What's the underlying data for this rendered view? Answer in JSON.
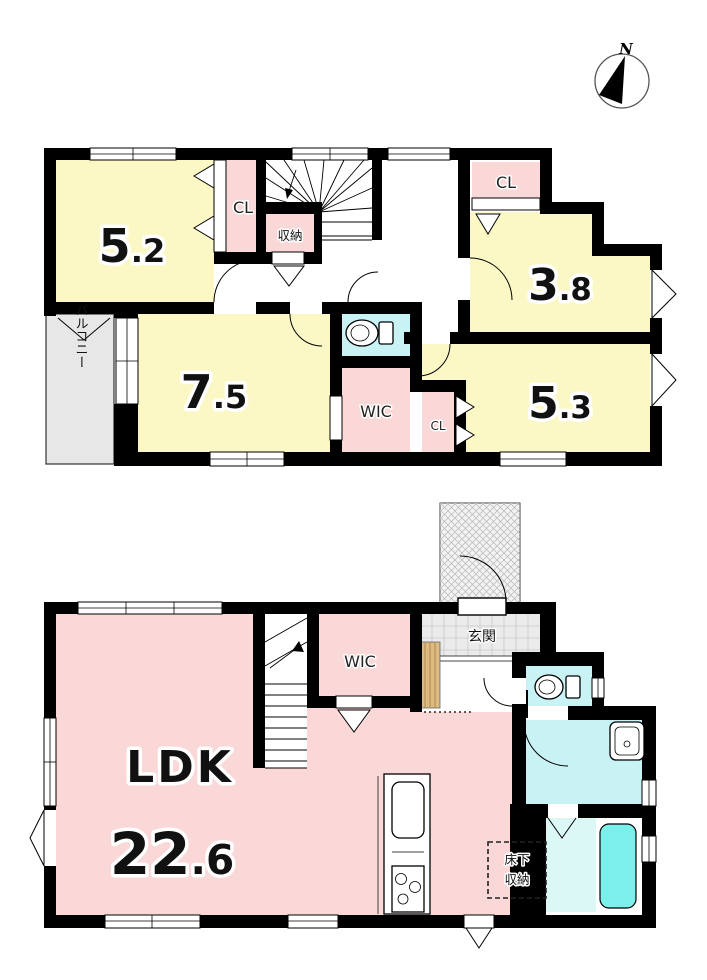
{
  "compass": {
    "north": "N"
  },
  "colors": {
    "room_yellow": "#FBF8C5",
    "room_pink": "#F9D8D7",
    "water_cyan": "#C9F2F5",
    "bathtub_cyan": "#7BEFEA",
    "shower_cyan": "#DCF8F6",
    "balcony_gray": "#E7E7E7",
    "entrance_tile_gray": "#EBEBEB",
    "wood_tan": "#DDBB80"
  },
  "floor_2f": {
    "room1": {
      "size": "5.2"
    },
    "closet1": {
      "label": "CL"
    },
    "storage": {
      "label": "収納"
    },
    "closet2": {
      "label": "CL"
    },
    "room2": {
      "size": "3.8"
    },
    "balcony": {
      "label": "バルコニー"
    },
    "room3": {
      "size": "7.5"
    },
    "wic": {
      "label": "WIC"
    },
    "closet3": {
      "label": "CL"
    },
    "room4": {
      "size": "5.3"
    }
  },
  "floor_1f": {
    "ldk": {
      "label": "LDK",
      "size": "22.6"
    },
    "wic": {
      "label": "WIC"
    },
    "entrance": {
      "label": "玄関"
    },
    "underfloor_storage": {
      "line1": "床下",
      "line2": "収納"
    }
  }
}
